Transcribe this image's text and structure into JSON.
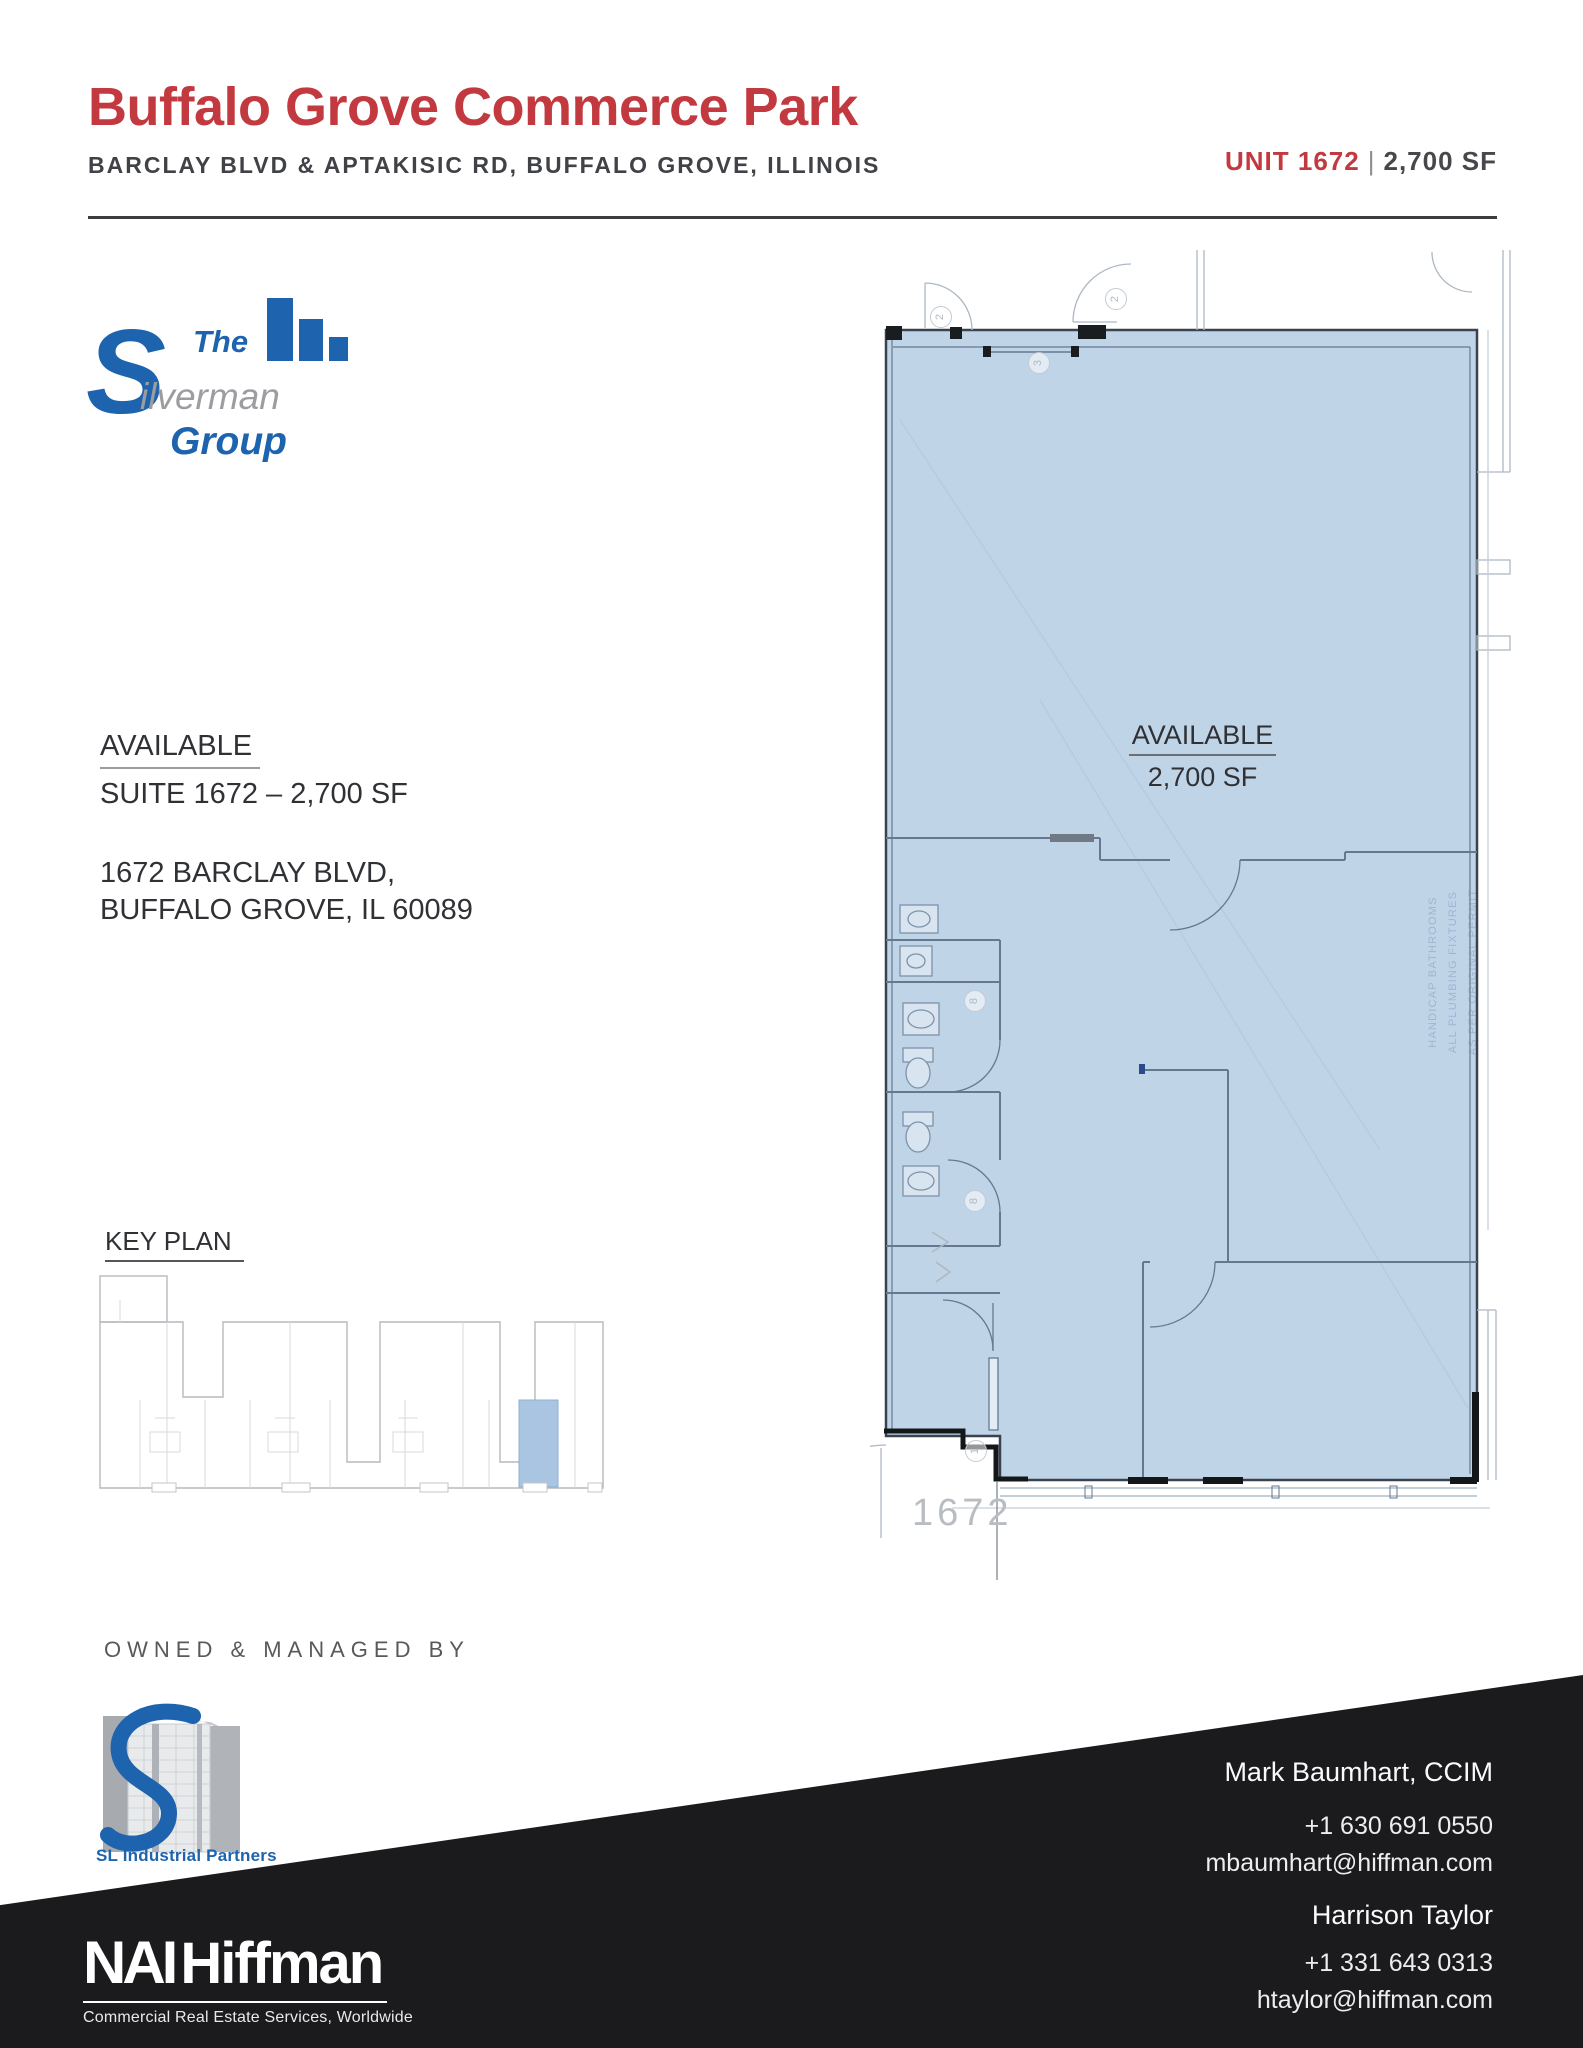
{
  "header": {
    "title": "Buffalo Grove Commerce Park",
    "subtitle": "BARCLAY BLVD & APTAKISIC RD, BUFFALO GROVE, ILLINOIS",
    "unit_label": "UNIT 1672",
    "separator": "|",
    "size_label": "2,700 SF"
  },
  "silverman_logo": {
    "word_the": "The",
    "letter_s": "S",
    "word_ilverman": "ilverman",
    "word_group": "Group"
  },
  "availability": {
    "heading": "AVAILABLE",
    "suite_line": "SUITE 1672 – 2,700 SF",
    "address_line1": "1672 BARCLAY BLVD,",
    "address_line2": "BUFFALO GROVE, IL 60089"
  },
  "floor_plan": {
    "available_label": "AVAILABLE",
    "size_label": "2,700 SF",
    "unit_number": "1672",
    "side_note_lines": [
      "HANDICAP BATHROOMS",
      "ALL PLUMBING FIXTURES",
      "AS PER ORIGINAL PERMIT"
    ],
    "circle_labels": {
      "door_a": "2",
      "door_b": "2",
      "storefront": "3",
      "bath_a": "8",
      "bath_b": "8",
      "entry": "1"
    },
    "fill_color": "#C0D4E8"
  },
  "key_plan": {
    "heading": "KEY PLAN"
  },
  "ownership": {
    "heading": "OWNED & MANAGED BY",
    "logo_text": "SL Industrial Partners"
  },
  "footer": {
    "contacts": [
      {
        "name": "Mark Baumhart, CCIM",
        "phone": "+1 630 691 0550",
        "email": "mbaumhart@hiffman.com"
      },
      {
        "name": "Harrison Taylor",
        "phone": "+1 331 643 0313",
        "email": "htaylor@hiffman.com"
      }
    ],
    "brand": {
      "nai": "NAI",
      "hiffman": "Hiffman",
      "tagline": "Commercial Real Estate Services, Worldwide"
    }
  },
  "colors": {
    "accent_red": "#C2393F",
    "silverman_blue": "#1E63AE",
    "plan_fill": "#C0D4E8",
    "key_plan_highlight": "#A9C5E1",
    "footer_black": "#1B1B1D"
  }
}
